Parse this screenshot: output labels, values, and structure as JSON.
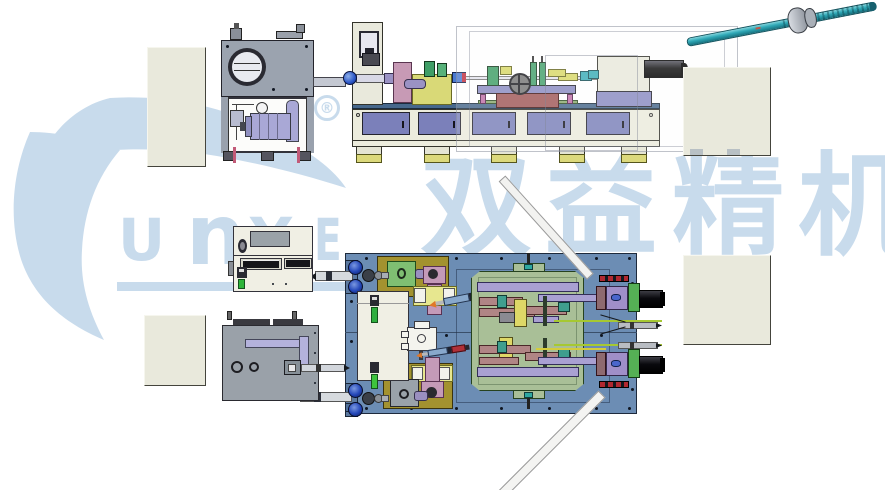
{
  "watermark": {
    "brand": "SUNYE",
    "letters": [
      "U",
      "n",
      "Y",
      "E"
    ],
    "registered_symbol": "®",
    "chinese_characters": [
      "双",
      "益",
      "精",
      "机"
    ],
    "color": "#c8dbec"
  },
  "palette": {
    "machine_bed_cream": "#ececdd",
    "cabinet_door_purple": "#7b80ba",
    "foot_pad_yellow": "#dcd97c",
    "base_plate_blue": "#6c8db4",
    "fixture_olive": "#a3922f",
    "fixture_green_plate": "#7fbf72",
    "fixture_yellow_plate": "#e7e78f",
    "arm_pink": "#c49ab8",
    "rail_lavender": "#a9a0d2",
    "block_rose": "#b08585",
    "ballscrew_teal": "#2fa8b6",
    "spindle_motor_blue": "#2b4fd0",
    "side_panel_beige": "#e9e9dc",
    "hydraulic_unit_gray": "#9ba3af",
    "red_table": "#a05858",
    "sensor_red": "#b03038",
    "probe_tip_orange": "#e07828",
    "laser_line_green": "#a6c832"
  }
}
